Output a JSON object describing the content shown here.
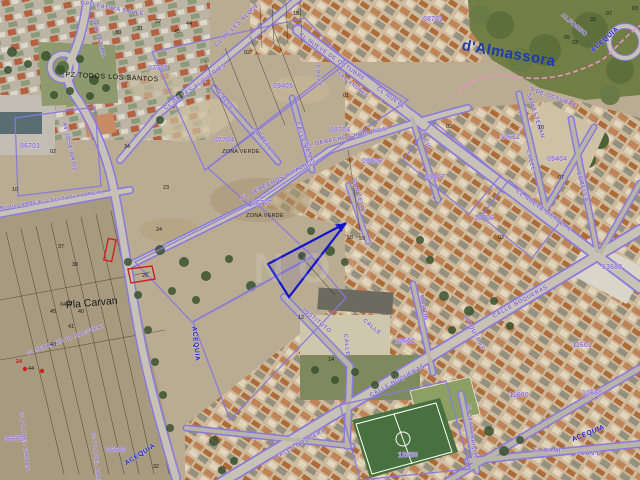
{
  "map": {
    "type_label": "cadastral-aerial-view",
    "colors": {
      "cadastral_purple": "#8a79dc",
      "sector_code_purple": "#8a6ce0",
      "street_label_purple": "#7a60cc",
      "municipality_blue": "#1d3aae",
      "water_blue": "#1717cf",
      "selection_arrow_blue": "#1414cc",
      "boundary_pink": "#ef93c6",
      "highlight_red": "#d02020"
    }
  },
  "place_labels": [
    {
      "text": "d'Almassora"
    },
    {
      "text": "Pla Carvan"
    },
    {
      "text": "PZ TODOS LOS SANTOS"
    }
  ],
  "zone_labels": [
    {
      "text": "ZONA VERDE"
    },
    {
      "text": "ZONA VERDE"
    }
  ],
  "water_labels": [
    {
      "text": "ACEQUIA"
    },
    {
      "text": "ACEQUIA"
    },
    {
      "text": "ACEQUIA"
    },
    {
      "text": "ACEQUIA"
    }
  ],
  "sector_codes": [
    {
      "text": "07705"
    },
    {
      "text": "07704"
    },
    {
      "text": "07707"
    },
    {
      "text": "08704"
    },
    {
      "text": "06701"
    },
    {
      "text": "09406"
    },
    {
      "text": "09407"
    },
    {
      "text": "10612"
    },
    {
      "text": "09404"
    },
    {
      "text": "10706"
    },
    {
      "text": "10601"
    },
    {
      "text": "11680"
    },
    {
      "text": "10680"
    },
    {
      "text": "11601"
    },
    {
      "text": "13680"
    },
    {
      "text": "06672"
    },
    {
      "text": "06680"
    },
    {
      "text": "12680"
    },
    {
      "text": "09405"
    },
    {
      "text": "08701"
    }
  ],
  "street_labels": [
    {
      "text": "GPO FATIMA CALLE"
    },
    {
      "text": "GPO FATIMA"
    },
    {
      "text": "CL DE LES ALQUERIES"
    },
    {
      "text": "CL DE LES ALQUE"
    },
    {
      "text": "CALLE"
    },
    {
      "text": "MORELLA"
    },
    {
      "text": "CL DERECHOS HUMANOS"
    },
    {
      "text": "CL DERECHOS HUMANOS"
    },
    {
      "text": "EL CID"
    },
    {
      "text": "CL NUEVE DE OCTUBRE"
    },
    {
      "text": "CL NUEVE OCTUBRE"
    },
    {
      "text": "9 DE OCTUBRE"
    },
    {
      "text": "SAN ESTEBAN"
    },
    {
      "text": "CALLE"
    },
    {
      "text": "CORELLA"
    },
    {
      "text": "ALFONSO"
    },
    {
      "text": "MARTIN"
    },
    {
      "text": "CALLE"
    },
    {
      "text": "CALLE"
    },
    {
      "text": "INSTITUTO"
    },
    {
      "text": "CALLE BOQUERAS"
    },
    {
      "text": "CALLE BOQUERAS"
    },
    {
      "text": "CALLE BOQUERA"
    },
    {
      "text": "CAMI VILLARREAL CALLE VILLARREAL"
    },
    {
      "text": "AV JOSE ORTIZ"
    },
    {
      "text": "CL SERRANIA DL MAESTRAT"
    },
    {
      "text": "CL PLA DEL CARVAN"
    },
    {
      "text": "CL PLA DEL CARVAN"
    },
    {
      "text": "CL SANTO CRISTO"
    },
    {
      "text": "EL CAMI"
    },
    {
      "text": "JUAN D"
    },
    {
      "text": "CALLE"
    },
    {
      "text": "SAN FELIX"
    },
    {
      "text": "CL NUEVE"
    },
    {
      "text": "SAN ANDRES"
    },
    {
      "text": "CALLE DE LE"
    },
    {
      "text": "BOQUERAS"
    }
  ],
  "parcel_numbers": [
    {
      "text": "30"
    },
    {
      "text": "21"
    },
    {
      "text": "22"
    },
    {
      "text": "44"
    },
    {
      "text": "45"
    },
    {
      "text": "02"
    },
    {
      "text": "18"
    },
    {
      "text": "02"
    },
    {
      "text": "10"
    },
    {
      "text": "34"
    },
    {
      "text": "23"
    },
    {
      "text": "24"
    },
    {
      "text": "26"
    },
    {
      "text": "37"
    },
    {
      "text": "38"
    },
    {
      "text": "40"
    },
    {
      "text": "41"
    },
    {
      "text": "43"
    },
    {
      "text": "44"
    },
    {
      "text": "45"
    },
    {
      "text": "58"
    },
    {
      "text": "59"
    },
    {
      "text": "02"
    },
    {
      "text": "33"
    },
    {
      "text": "65"
    },
    {
      "text": "02"
    },
    {
      "text": "03"
    },
    {
      "text": "07"
    },
    {
      "text": "02"
    },
    {
      "text": "10"
    },
    {
      "text": "07"
    },
    {
      "text": "12"
    },
    {
      "text": "14"
    },
    {
      "text": "32"
    },
    {
      "text": "0469"
    },
    {
      "text": "01"
    }
  ],
  "red_labels": [
    {
      "text": "24"
    }
  ],
  "watermark": {
    "text": "NOS"
  }
}
